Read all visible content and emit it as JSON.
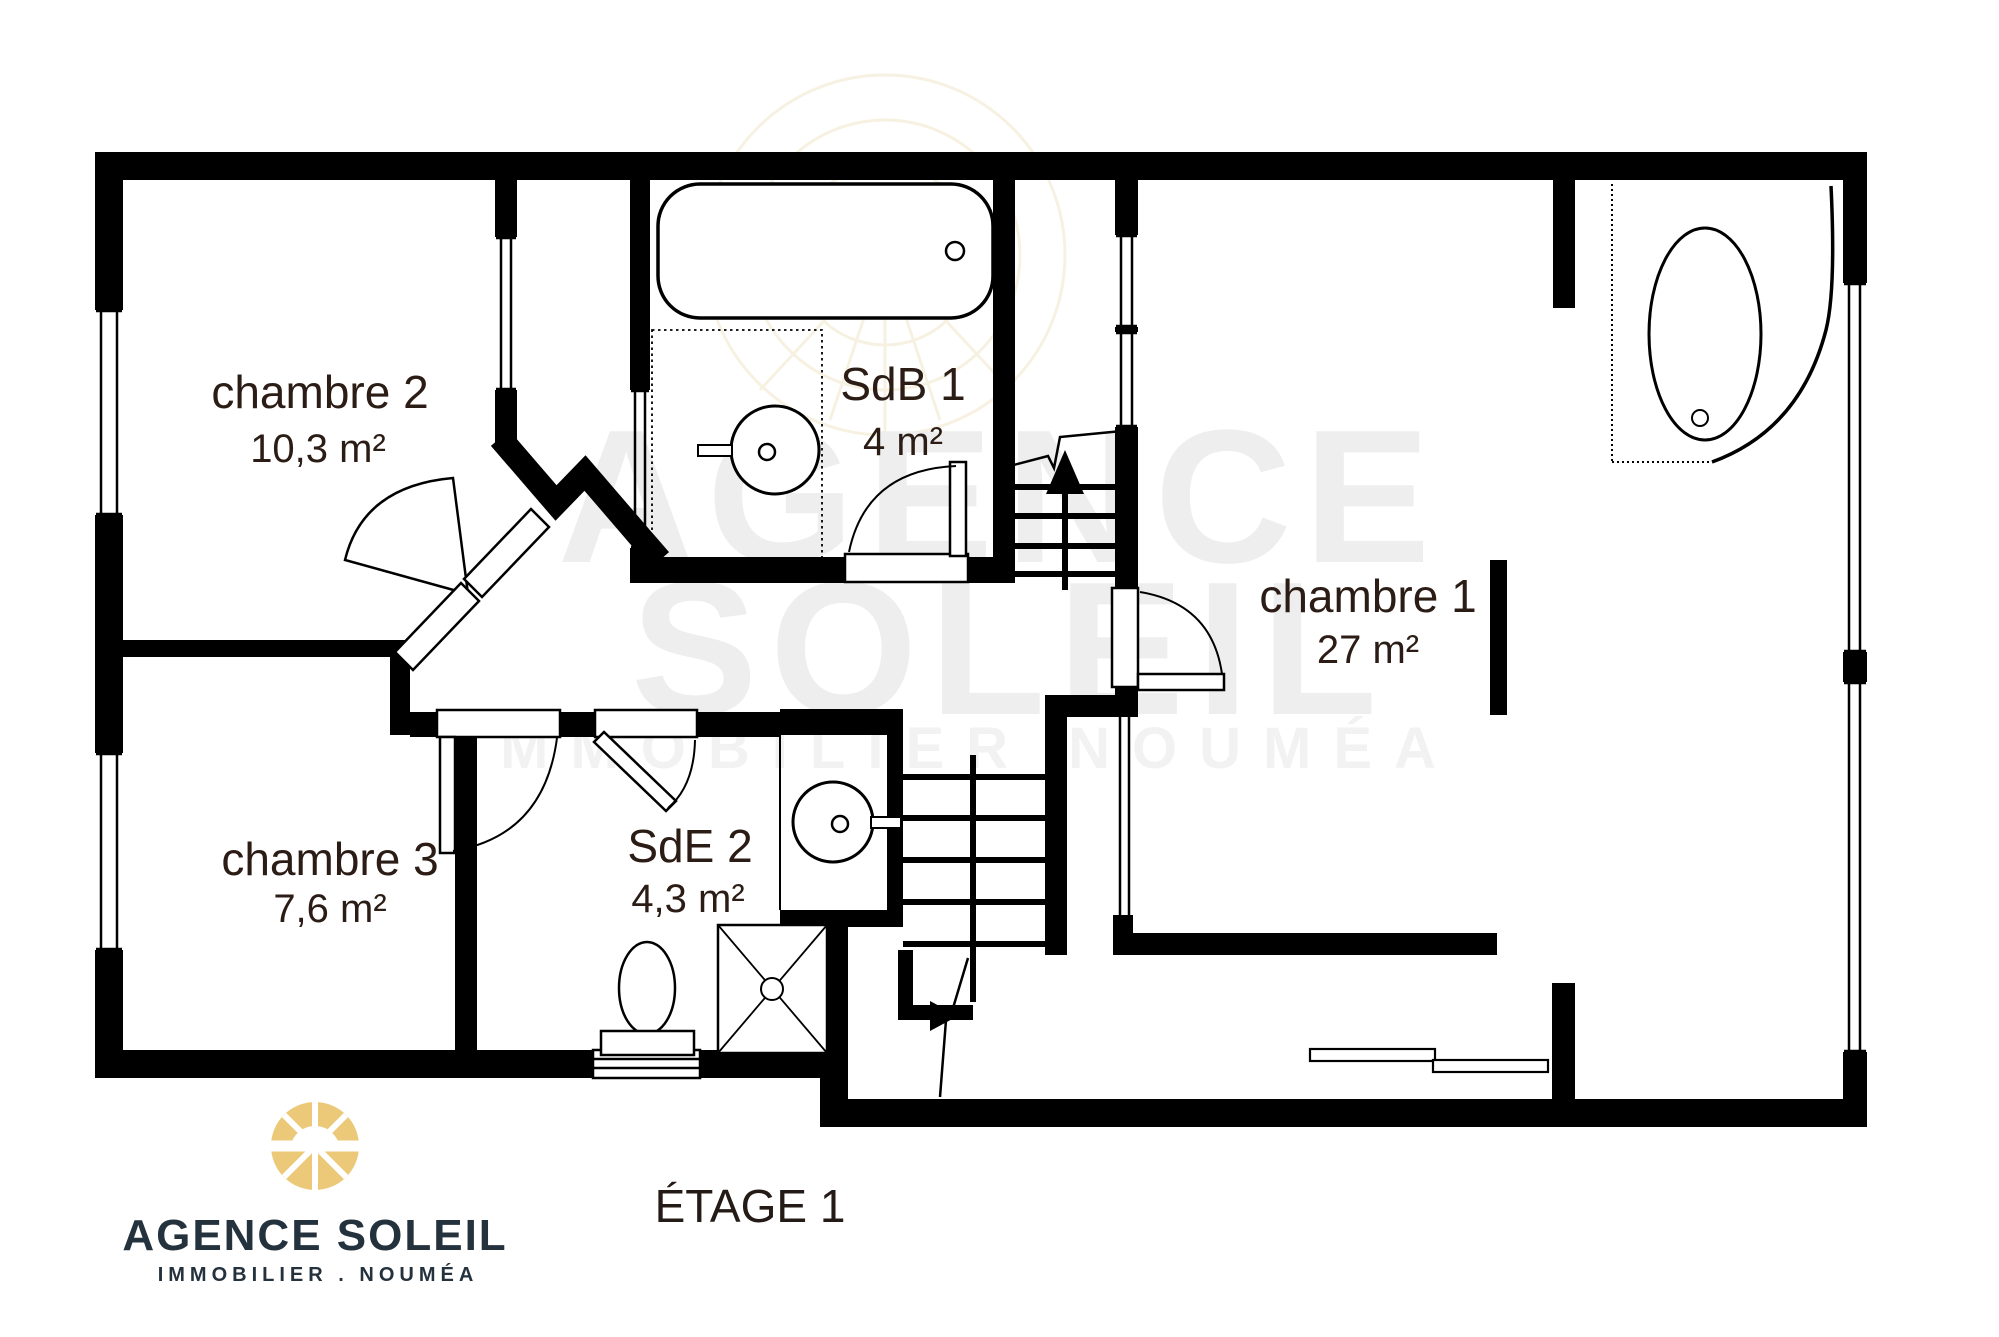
{
  "floor_plan": {
    "title": "ÉTAGE 1",
    "rooms": [
      {
        "name": "chambre 2",
        "area": "10,3 m²"
      },
      {
        "name": "SdB 1",
        "area": "4 m²"
      },
      {
        "name": "chambre 1",
        "area": "27 m²"
      },
      {
        "name": "chambre 3",
        "area": "7,6 m²"
      },
      {
        "name": "SdE 2",
        "area": "4,3 m²"
      }
    ],
    "fixtures": [
      "bathtub-icon",
      "corner-bathtub-icon",
      "sink-icon",
      "toilet-icon",
      "shower-icon",
      "staircase-up-icon",
      "staircase-down-icon",
      "door-swing-icon",
      "window-icon",
      "sliding-window-icon"
    ],
    "colors": {
      "wall": "#000000",
      "label": "#2b1c15",
      "background": "#ffffff"
    }
  },
  "watermark": {
    "line1": "AGENCE",
    "line2": "SOLEIL",
    "line3": "IMMOBILIER NOUMÉA"
  },
  "logo": {
    "name": "AGENCE SOLEIL",
    "tagline": "IMMOBILIER . NOUMÉA",
    "sun_color": "#ecc979",
    "text_color": "#24323e"
  }
}
